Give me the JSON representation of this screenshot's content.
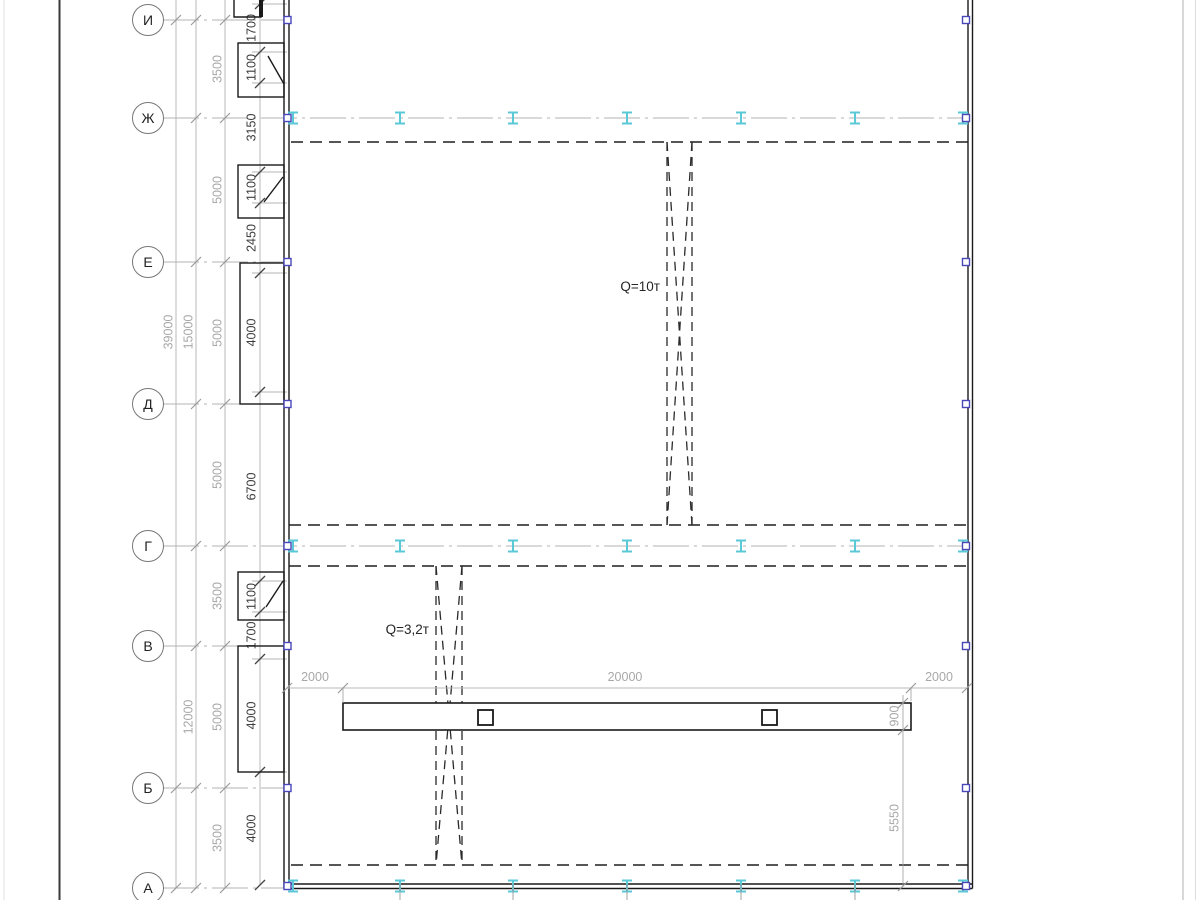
{
  "axes": [
    "И",
    "Ж",
    "Е",
    "Д",
    "Г",
    "В",
    "Б",
    "А"
  ],
  "dims": {
    "inner": [
      "1700",
      "1100",
      "3150",
      "1100",
      "2450",
      "4000",
      "6700",
      "1100",
      "1700",
      "4000",
      "4000"
    ],
    "bays": [
      "3500",
      "5000",
      "5000",
      "5000",
      "3500",
      "5000",
      "3500"
    ],
    "groups": [
      "15000",
      "12000"
    ],
    "overall": "39000",
    "beam_left": "2000",
    "beam_span": "20000",
    "beam_right": "2000",
    "beam_width": "900",
    "beam_offset": "5550"
  },
  "cranes": [
    {
      "label": "Q=10т"
    },
    {
      "label": "Q=3,2т"
    }
  ],
  "colors": {
    "marker_blue": "#4a47b8",
    "ibeam_cyan": "#5bc8d8",
    "line_dark": "#1a1a1a",
    "dim_light": "#a8a8a8",
    "dim_dark": "#3c3c3c"
  }
}
